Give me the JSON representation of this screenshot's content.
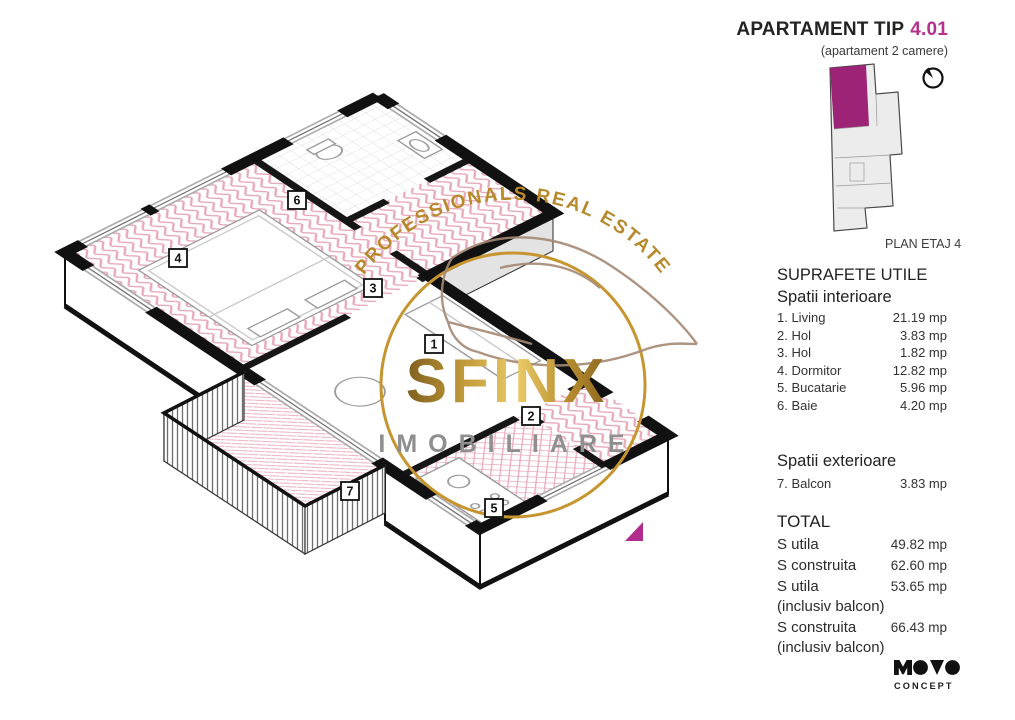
{
  "header": {
    "title": "APARTAMENT TIP",
    "unit": "4.01",
    "subtitle": "(apartament 2 camere)"
  },
  "mini_plan": {
    "caption": "PLAN ETAJ 4"
  },
  "suprafete": {
    "title": "SUPRAFETE UTILE",
    "interior_title": "Spatii interioare",
    "interior_rows": [
      {
        "label": "1. Living",
        "value": "21.19 mp"
      },
      {
        "label": "2. Hol",
        "value": "3.83 mp"
      },
      {
        "label": "3. Hol",
        "value": "1.82 mp"
      },
      {
        "label": "4. Dormitor",
        "value": "12.82 mp"
      },
      {
        "label": "5. Bucatarie",
        "value": "5.96 mp"
      },
      {
        "label": "6. Baie",
        "value": "4.20 mp"
      }
    ],
    "exterior_title": "Spatii exterioare",
    "exterior_rows": [
      {
        "label": "7. Balcon",
        "value": "3.83 mp"
      }
    ],
    "total_title": "TOTAL",
    "total_rows": [
      {
        "label": "S utila",
        "value": "49.82 mp"
      },
      {
        "label": "S construita",
        "value": "62.60 mp"
      },
      {
        "label": "S utila",
        "value": "53.65 mp",
        "note": "(inclusiv balcon)"
      },
      {
        "label": "S construita",
        "value": "66.43 mp",
        "note": "(inclusiv balcon)"
      }
    ]
  },
  "watermark": {
    "arc_text": "PROFESSIONALS REAL ESTATE",
    "brand": "SFINX",
    "brand_sub": "IMOBILIARE"
  },
  "floor_plan": {
    "room_labels": [
      "1",
      "2",
      "3",
      "4",
      "5",
      "6",
      "7"
    ]
  },
  "logo": {
    "brand": "MONO",
    "sub": "CONCEPT"
  },
  "colors": {
    "magenta": "#A8268A",
    "gold": "#C2973B",
    "floor_pink": "#E9A8BA",
    "text": "#2D2D2D"
  }
}
